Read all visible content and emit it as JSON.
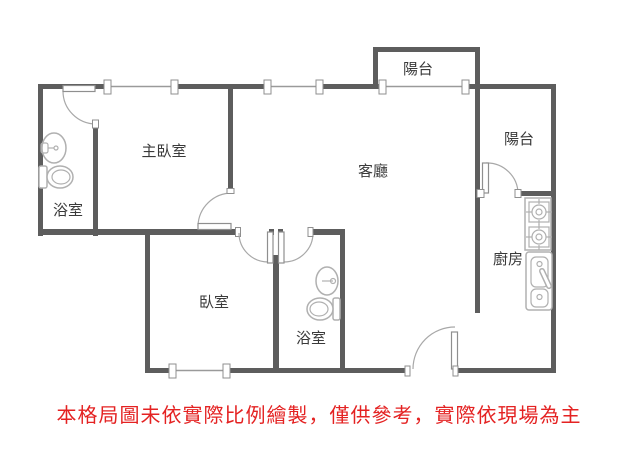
{
  "colors": {
    "wall": "#5d5d5d",
    "glass": "#9a9a9a",
    "door_arc": "#a8a8a8",
    "fixture": "#b0b0b0",
    "label_text": "#3a3a3a",
    "disclaimer_text": "#e42222",
    "background": "#ffffff"
  },
  "rooms": {
    "master_bedroom": {
      "label": "主臥室"
    },
    "bathroom_main": {
      "label": "浴室"
    },
    "bedroom": {
      "label": "臥室"
    },
    "bathroom_second": {
      "label": "浴室"
    },
    "living_room": {
      "label": "客廳"
    },
    "kitchen": {
      "label": "廚房"
    },
    "balcony_top": {
      "label": "陽台"
    },
    "balcony_right": {
      "label": "陽台"
    }
  },
  "fixtures": {
    "bathroom_main": [
      "sink-icon",
      "toilet-icon"
    ],
    "bathroom_second": [
      "sink-icon",
      "toilet-icon"
    ],
    "kitchen": [
      "stove-two-burner-icon",
      "kitchen-sink-counter-icon"
    ]
  },
  "disclaimer": {
    "text": "本格局圖未依實際比例繪製，僅供參考，實際依現場為主"
  }
}
